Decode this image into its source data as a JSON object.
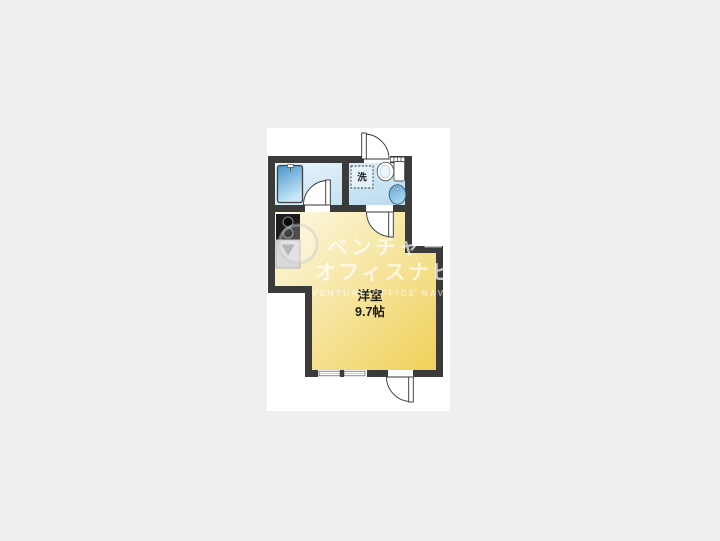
{
  "page": {
    "background": "#efefef",
    "canvas_background": "#ffffff"
  },
  "floorplan": {
    "room_label": {
      "line1": "洋室",
      "line2": "9.7帖"
    },
    "laundry_label": "洗",
    "colors": {
      "wall": "#3b3b3b",
      "wet_light": "#edf6fc",
      "wet_deep": "#b5d9f0",
      "room_light": "#fdfae8",
      "room_deep": "#efcf55",
      "tub_dark": "#4795c9",
      "tub_light": "#c8e8f8",
      "basin_dark": "#5fa9d8",
      "basin_light": "#a9d6ef",
      "label_color": "#1a1a1a",
      "door_line": "#333333",
      "fixture_line": "#555555"
    }
  },
  "watermark": {
    "line1": "ベンチャー",
    "line2": "オフィスナビ",
    "line3": "VENTURE OFFICE NAVI"
  }
}
